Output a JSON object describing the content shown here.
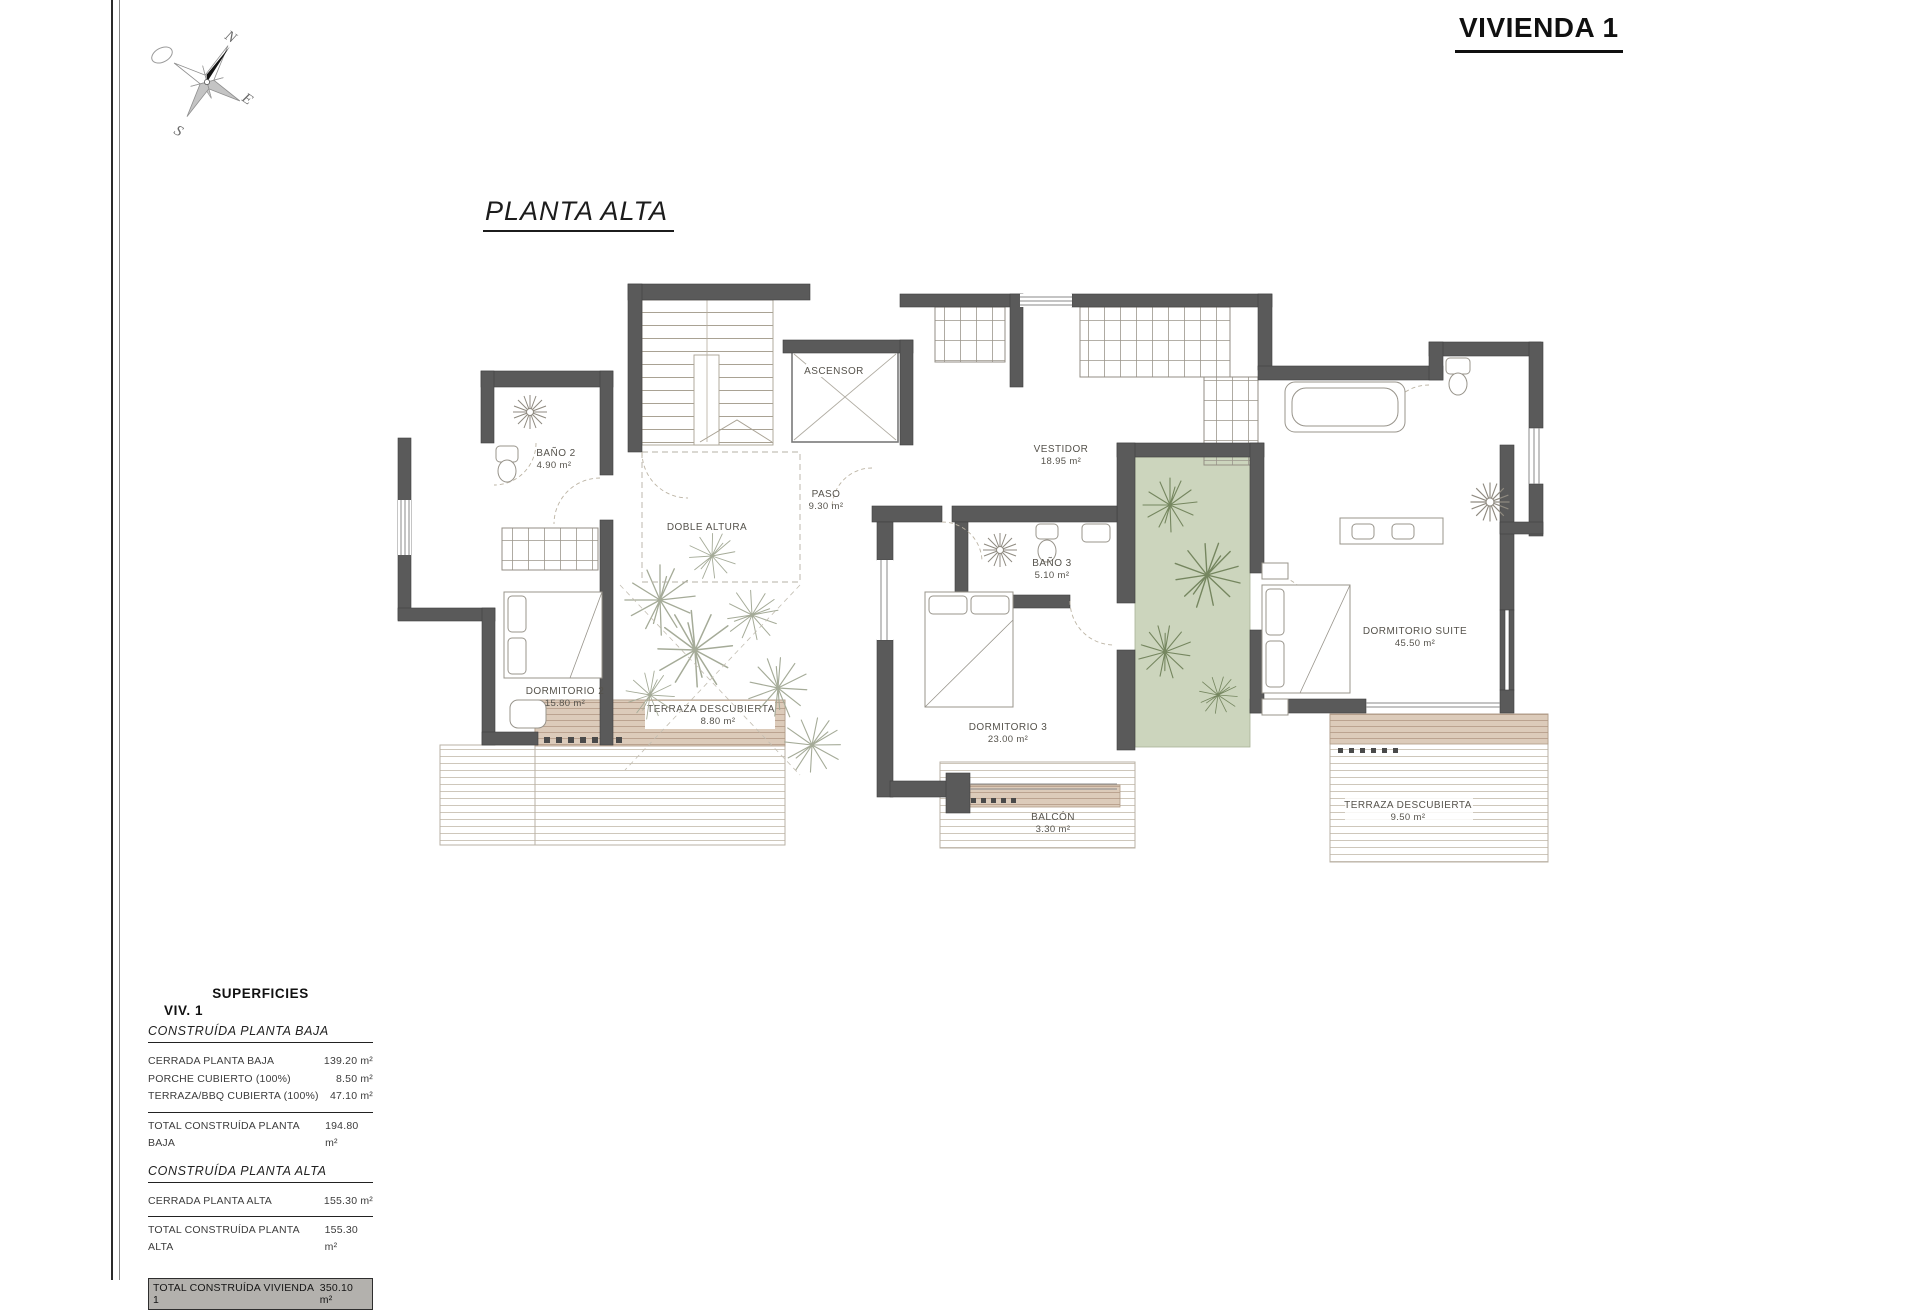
{
  "sheet": {
    "title": "VIVIENDA 1",
    "plan_title": "PLANTA ALTA"
  },
  "compass": {
    "n": "N",
    "s": "S",
    "e": "E",
    "o": "O"
  },
  "rooms": [
    {
      "name": "BAÑO 2",
      "area": "4.90 m²"
    },
    {
      "name": "ASCENSOR",
      "area": ""
    },
    {
      "name": "VESTIDOR",
      "area": "18.95 m²"
    },
    {
      "name": "PASO",
      "area": "9.30 m²"
    },
    {
      "name": "DOBLE ALTURA",
      "area": ""
    },
    {
      "name": "BAÑO 3",
      "area": "5.10 m²"
    },
    {
      "name": "DORMITORIO 2",
      "area": "15.80 m²"
    },
    {
      "name": "TERRAZA DESCUBIERTA",
      "area": "8.80 m²"
    },
    {
      "name": "DORMITORIO 3",
      "area": "23.00 m²"
    },
    {
      "name": "BALCÓN",
      "area": "3.30 m²"
    },
    {
      "name": "DORMITORIO SUITE",
      "area": "45.50 m²"
    },
    {
      "name": "TERRAZA DESCUBIERTA",
      "area": "9.50 m²"
    }
  ],
  "surfaces_table": {
    "heading": "SUPERFICIES",
    "subheading": "VIV. 1",
    "sections": [
      {
        "title": "CONSTRUÍDA PLANTA BAJA",
        "rows": [
          {
            "label": "CERRADA PLANTA BAJA",
            "value": "139.20 m²"
          },
          {
            "label": "PORCHE CUBIERTO (100%)",
            "value": "8.50 m²"
          },
          {
            "label": "TERRAZA/BBQ CUBIERTA (100%)",
            "value": "47.10 m²"
          }
        ],
        "total": {
          "label": "TOTAL CONSTRUÍDA PLANTA BAJA",
          "value": "194.80 m²"
        }
      },
      {
        "title": "CONSTRUÍDA PLANTA ALTA",
        "rows": [
          {
            "label": "CERRADA PLANTA ALTA",
            "value": "155.30 m²"
          }
        ],
        "total": {
          "label": "TOTAL CONSTRUÍDA PLANTA ALTA",
          "value": "155.30 m²"
        }
      }
    ],
    "grand_total": {
      "label": "TOTAL CONSTRUÍDA VIVIENDA 1",
      "value": "350.10 m²"
    }
  }
}
